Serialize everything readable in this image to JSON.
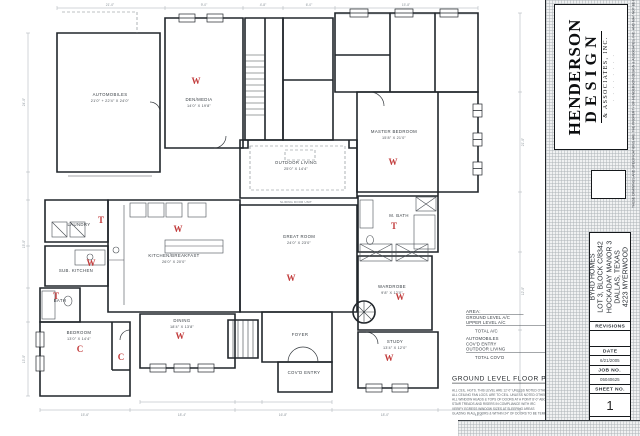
{
  "title_block": {
    "firm_name_1": "HENDERSON",
    "firm_name_2": "DESIGN",
    "firm_name_3": "& ASSOCIATES, INC.",
    "firm_tagline": "· · · · · · · ·",
    "project_lines": [
      "BYRD HOMES",
      "LOT 3, BLOCK C/8342",
      "HOCKADAY MANOR 3",
      "DALLAS, TEXAS",
      "4223 MYERWOOD"
    ],
    "revisions_label": "REVISIONS",
    "date_label": "DATE",
    "date_value": "6/21/2005",
    "job_label": "JOB NO.",
    "job_value": "05040625",
    "sheet_label": "SHEET NO.",
    "sheet_value": "1",
    "copyright_strip": "THESE DRAWINGS AND SPECIFICATIONS ARE THE PROPERTY OF HENDERSON DESIGN & ASSOCIATES, INC. AND MAY NOT BE REPRODUCED IN WHOLE OR IN PART WITHOUT WRITTEN CONSENT"
  },
  "plan": {
    "title": "GROUND LEVEL FLOOR PLAN",
    "scale": "1/4\" = 1'-0\"",
    "wall_note": "SLIDING DOOR UNIT",
    "rooms": [
      {
        "name": "AUTOMOBILES",
        "dims": "21'0\" + 22'4\" X 24'0\""
      },
      {
        "name": "DEN/MEDIA",
        "dims": "14'0\" X 19'8\""
      },
      {
        "name": "MASTER BEDROOM",
        "dims": "15'8\" X 21'0\""
      },
      {
        "name": "OUTDOOR LIVING",
        "dims": "25'0\" X 14'4\""
      },
      {
        "name": "GREAT ROOM",
        "dims": "24'0\" X 23'0\""
      },
      {
        "name": "KITCHEN/BREAKFAST",
        "dims": "26'0\" X 20'0\""
      },
      {
        "name": "LAUNDRY",
        "dims": ""
      },
      {
        "name": "SUB. KITCHEN",
        "dims": ""
      },
      {
        "name": "BATH",
        "dims": ""
      },
      {
        "name": "BEDROOM",
        "dims": "13'0\" X 14'4\""
      },
      {
        "name": "DINING",
        "dims": "18'4\" X 13'8\""
      },
      {
        "name": "FOYER",
        "dims": ""
      },
      {
        "name": "COV'D ENTRY",
        "dims": ""
      },
      {
        "name": "STUDY",
        "dims": "13'4\" X 12'0\""
      },
      {
        "name": "M. BATH",
        "dims": ""
      },
      {
        "name": "WARDROBE",
        "dims": "9'8\" X 12'0\""
      }
    ],
    "markers": [
      "W",
      "W",
      "W",
      "W",
      "W",
      "W",
      "W",
      "W",
      "T",
      "T",
      "T",
      "C",
      "C"
    ],
    "area_table": {
      "header": "AREA:",
      "rows": [
        {
          "label": "GROUND LEVEL A/C",
          "value": "4106"
        },
        {
          "label": "UPPER LEVEL A/C",
          "value": "715"
        },
        {
          "label": "TOTAL A/C",
          "value": "4821"
        },
        {
          "label": "AUTOMOBILES",
          "value": "843"
        },
        {
          "label": "COV'D ENTRY",
          "value": "48"
        },
        {
          "label": "OUTDOOR LIVING",
          "value": "500"
        },
        {
          "label": "TOTAL COV'D",
          "value": "6212"
        }
      ]
    },
    "notes": [
      "ALL CEIL. HGTS. THIS LEVEL ARE 12'-0\" UNLESS NOTED OTHERWISE",
      "ALL CEILING FAN LOCS. ARE TO CEIL. UNLESS NOTED OTHERWISE",
      "ALL WINDOW HEADS & TOPS OF DOORS AT A POINT 8'-0\" ABOVE FIN. FLOOR OF ADJOINING ROOM (SEE ELEVATIONS)",
      "STAIR TREADS AND RISERS IN COMPLIANCE WITH IRC",
      "VERIFY EGRESS WINDOW SIZES AT SLEEPING AREAS",
      "GLAZING IN ALL DOORS & WITHIN 24\" OF DOORS TO BE TEMPERED SAFETY GLASS"
    ],
    "dims": [
      "21'-0\"",
      "9'-0\"",
      "4'-8\"",
      "6'-0\"",
      "15'-8\"",
      "24'-0\"",
      "15'-0\"",
      "13'-0\"",
      "21'-0\"",
      "12'-0\"",
      "15'-6\"",
      "18'-4\"",
      "16'-8\"",
      "18'-0\"",
      "14'-0\""
    ]
  }
}
